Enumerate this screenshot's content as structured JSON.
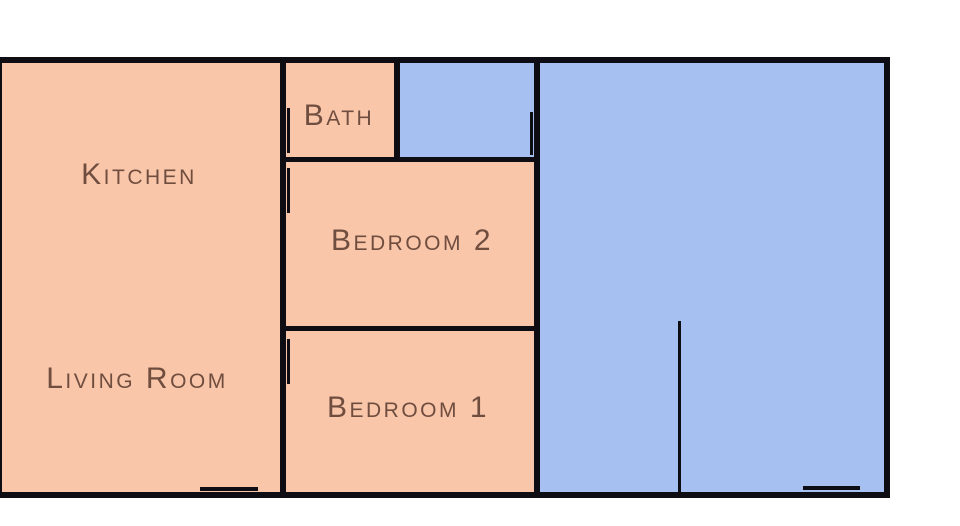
{
  "title": "Apartment floor plan",
  "colors": {
    "background": "#ffffff",
    "room_warm": "#fac6a9",
    "room_cool": "#a6c0f1",
    "wall": "#0d0d13",
    "label": "#6f4d3f"
  },
  "rooms": [
    {
      "id": "kitchen",
      "label": "Kitchen",
      "fill": "warm"
    },
    {
      "id": "living-room",
      "label": "Living Room",
      "fill": "warm"
    },
    {
      "id": "bath",
      "label": "Bath",
      "fill": "warm"
    },
    {
      "id": "bedroom-2",
      "label": "Bedroom 2",
      "fill": "warm"
    },
    {
      "id": "bedroom-1",
      "label": "Bedroom 1",
      "fill": "warm"
    },
    {
      "id": "small-unlabeled-room",
      "label": "",
      "fill": "cool"
    },
    {
      "id": "large-unlabeled-room",
      "label": "",
      "fill": "cool"
    }
  ]
}
